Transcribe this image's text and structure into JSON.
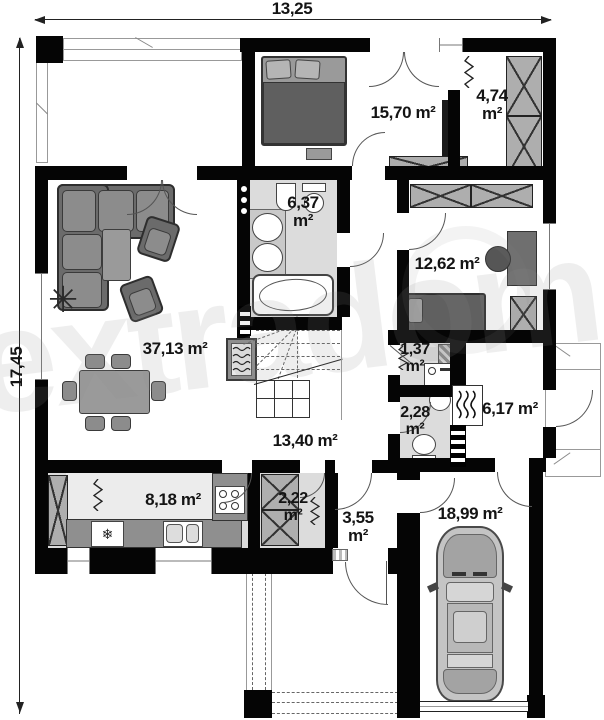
{
  "dimensions": {
    "width": "13,25",
    "height": "17,45"
  },
  "rooms": {
    "bedroom_top": "15,70 m²",
    "dressing_v": "4,74",
    "dressing_u": "m²",
    "bathroom_v": "6,37",
    "bathroom_u": "m²",
    "bedroom_right": "12,62 m²",
    "living": "37,13 m²",
    "laundry_v": "1,37",
    "laundry_u": "m²",
    "wc_v": "2,28",
    "wc_u": "m²",
    "boiler": "6,17 m²",
    "hall": "13,40 m²",
    "kitchen": "8,18 m²",
    "pantry_v": "2,22",
    "pantry_u": "m²",
    "vestibule_v": "3,55",
    "vestibule_u": "m²",
    "garage": "18,99 m²"
  },
  "watermark": "extradom",
  "icons": {
    "snowflake": "❄",
    "plant": "✳"
  },
  "colors": {
    "wall": "#050505",
    "tile_floor": "#dcdcdc",
    "furniture_dark": "#6b6b6b",
    "furniture_mid": "#8c8c8c",
    "counter": "#8f8f8f"
  }
}
